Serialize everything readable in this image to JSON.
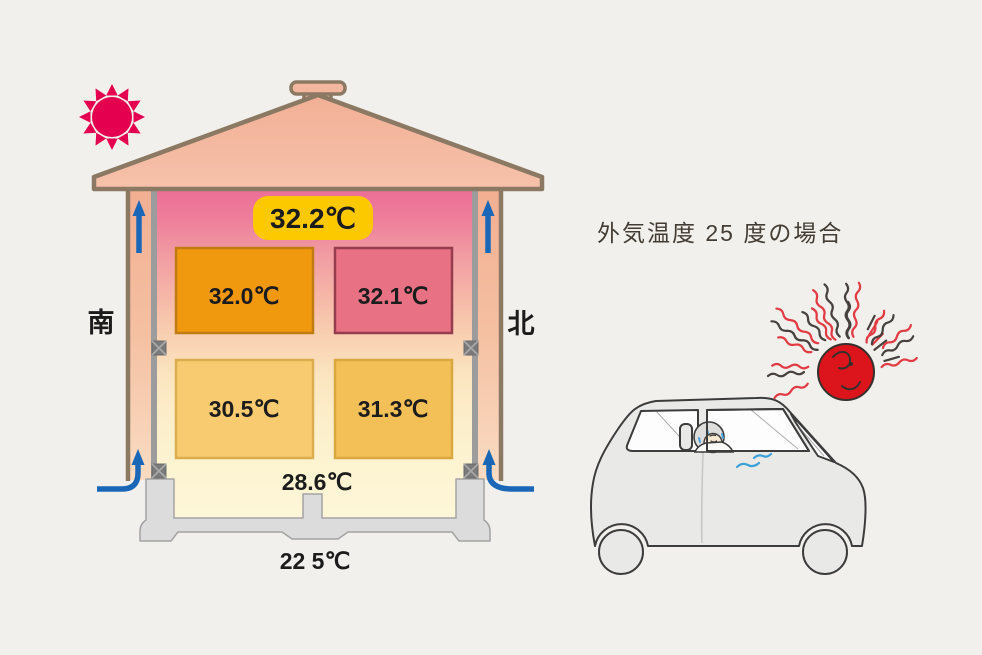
{
  "scene": {
    "heading": "外気温度 25 度の場合"
  },
  "house": {
    "south_label": "南",
    "north_label": "北",
    "attic_temp": "32.2℃",
    "rooms": [
      {
        "position": "upper-left",
        "temp": "32.0℃"
      },
      {
        "position": "upper-right",
        "temp": "32.1℃"
      },
      {
        "position": "lower-left",
        "temp": "30.5℃"
      },
      {
        "position": "lower-right",
        "temp": "31.3℃"
      }
    ],
    "underfloor_temp": "28.6℃",
    "ground_temp": "22 5℃"
  },
  "icons": {
    "small_sun": "sun-icon",
    "hot_sun": "hot-sun-icon",
    "car": "car-illustration",
    "airflow": "arrow-up-icon"
  },
  "colors": {
    "background": "#f1f0ec",
    "sun_magenta": "#e5004f",
    "roof_salmon": "#f4b6a0",
    "outline_brown": "#8c7963",
    "badge_yellow": "#fcc800",
    "room_upper_left": "#f0990f",
    "room_upper_right": "#e87183",
    "room_lower_left": "#f8cb71",
    "room_lower_right": "#f3c058",
    "arrow_blue": "#1a67b8",
    "hot_sun_red": "#dc141c",
    "car_body_gray": "#e9e9e8"
  }
}
